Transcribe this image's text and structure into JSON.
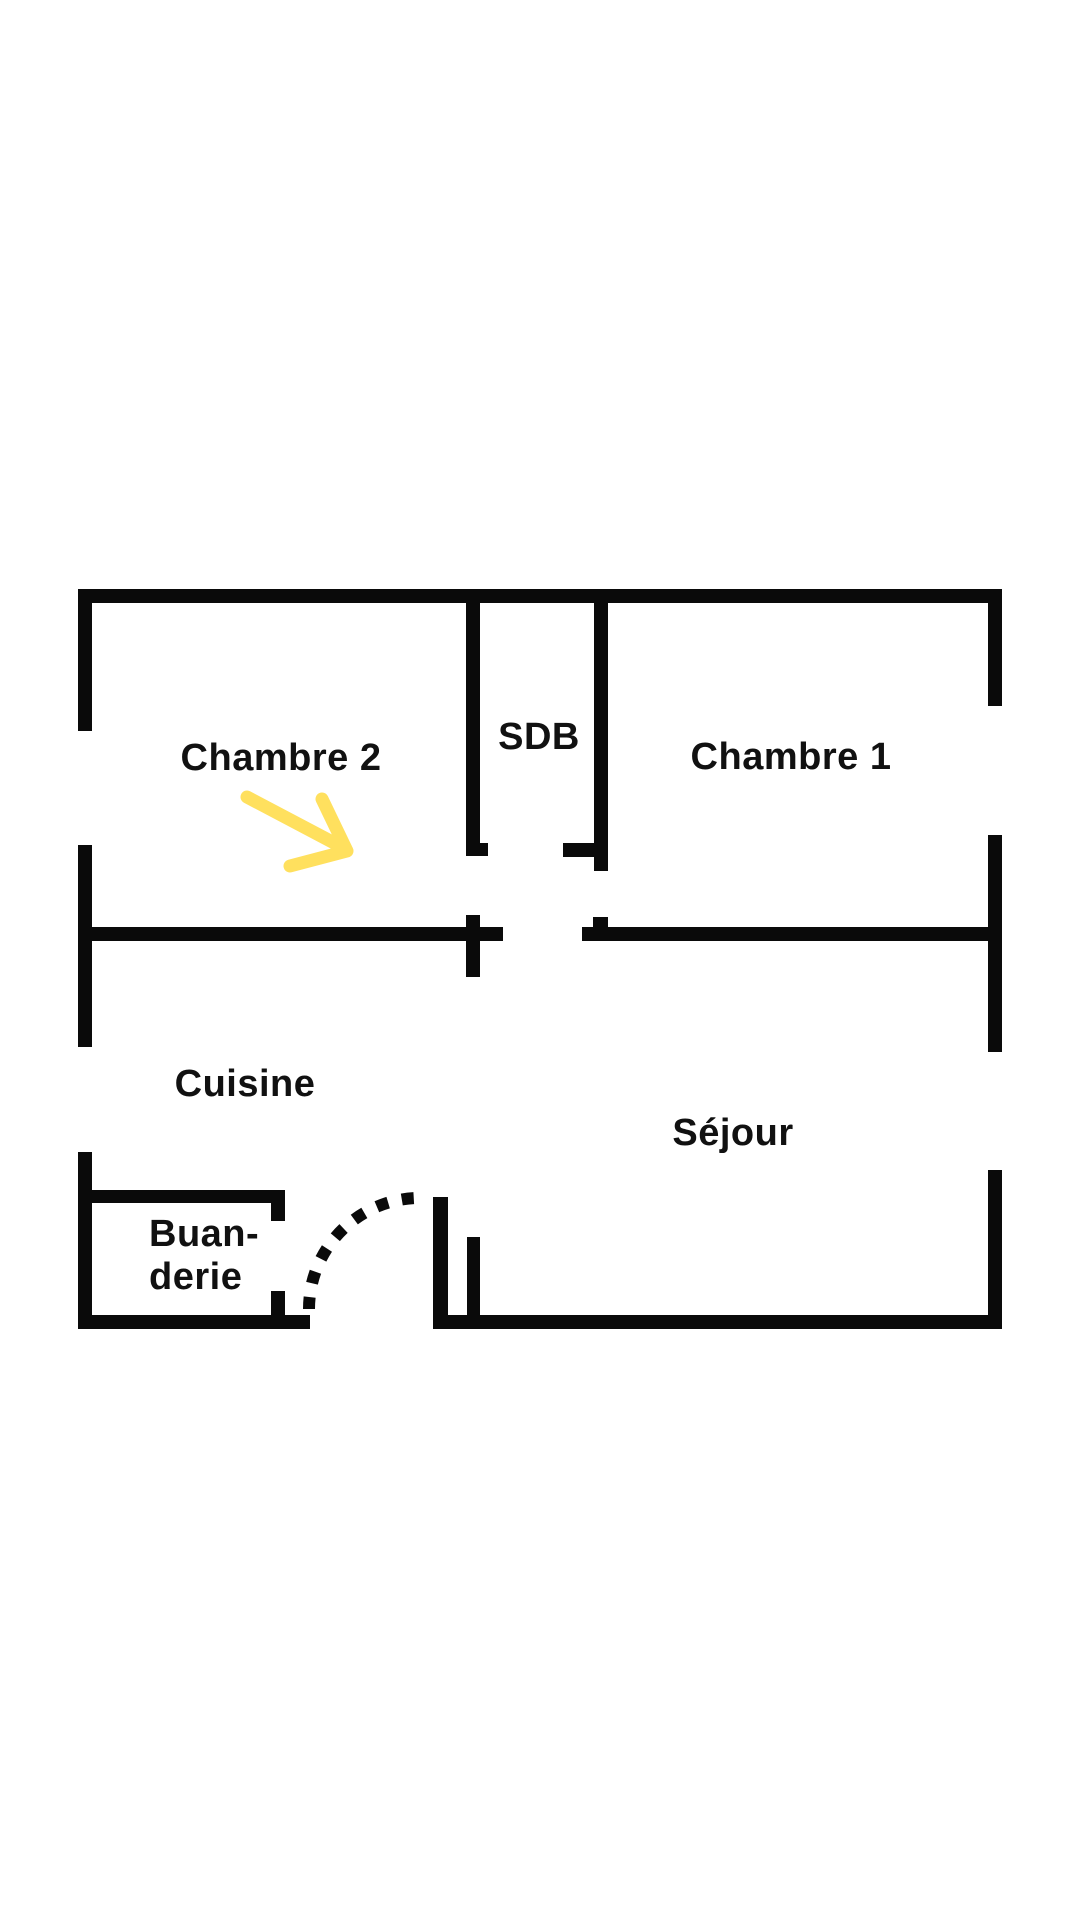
{
  "title": "Apartment floor plan",
  "background": "#ffffff",
  "plan": {
    "wall_color": "#0a0a0a",
    "text_color": "#111111",
    "labels": [
      {
        "id": "chambre-2",
        "text": "Chambre 2"
      },
      {
        "id": "sdb",
        "text": "SDB"
      },
      {
        "id": "chambre-1",
        "text": "Chambre 1"
      },
      {
        "id": "cuisine",
        "text": "Cuisine"
      },
      {
        "id": "sejour",
        "text": "Séjour"
      },
      {
        "id": "buanderie-line1",
        "text": "Buan-"
      },
      {
        "id": "buanderie-line2",
        "text": "derie"
      }
    ],
    "walls": [
      {
        "name": "outer-top-wall",
        "x": 78,
        "y": 589,
        "w": 924,
        "h": 14
      },
      {
        "name": "outer-left-wall-upper",
        "x": 78,
        "y": 589,
        "w": 14,
        "h": 142
      },
      {
        "name": "outer-left-wall-middle",
        "x": 78,
        "y": 845,
        "w": 14,
        "h": 202
      },
      {
        "name": "outer-left-wall-lower",
        "x": 78,
        "y": 1152,
        "w": 14,
        "h": 177
      },
      {
        "name": "outer-right-wall-upper",
        "x": 988,
        "y": 589,
        "w": 14,
        "h": 117
      },
      {
        "name": "outer-right-wall-middle",
        "x": 988,
        "y": 835,
        "w": 14,
        "h": 217
      },
      {
        "name": "outer-right-wall-lower",
        "x": 988,
        "y": 1170,
        "w": 14,
        "h": 159
      },
      {
        "name": "sdb-left-wall",
        "x": 466,
        "y": 603,
        "w": 14,
        "h": 253
      },
      {
        "name": "sdb-left-door-jamb",
        "x": 466,
        "y": 843,
        "w": 22,
        "h": 13
      },
      {
        "name": "sdb-right-wall",
        "x": 594,
        "y": 603,
        "w": 14,
        "h": 268
      },
      {
        "name": "sdb-right-door-jamb",
        "x": 563,
        "y": 843,
        "w": 31,
        "h": 14
      },
      {
        "name": "middle-wall-left",
        "x": 78,
        "y": 927,
        "w": 425,
        "h": 14
      },
      {
        "name": "middle-wall-cross-stub",
        "x": 466,
        "y": 915,
        "w": 14,
        "h": 62
      },
      {
        "name": "middle-wall-right",
        "x": 582,
        "y": 927,
        "w": 420,
        "h": 14
      },
      {
        "name": "middle-wall-top-stub",
        "x": 593,
        "y": 917,
        "w": 15,
        "h": 10
      },
      {
        "name": "bottom-wall-left",
        "x": 78,
        "y": 1315,
        "w": 232,
        "h": 14
      },
      {
        "name": "bottom-wall-right",
        "x": 433,
        "y": 1315,
        "w": 569,
        "h": 14
      },
      {
        "name": "buanderie-top-wall",
        "x": 78,
        "y": 1190,
        "w": 207,
        "h": 13
      },
      {
        "name": "buanderie-top-wall-jamb",
        "x": 271,
        "y": 1190,
        "w": 14,
        "h": 31
      },
      {
        "name": "buanderie-door-jamb",
        "x": 271,
        "y": 1291,
        "w": 14,
        "h": 24
      },
      {
        "name": "kitchen-door-leaf",
        "x": 433,
        "y": 1197,
        "w": 15,
        "h": 132
      },
      {
        "name": "sejour-entry-stub",
        "x": 467,
        "y": 1237,
        "w": 13,
        "h": 92
      }
    ],
    "door_arc": {
      "path": "M 309 1309 A 111 111 0 0 1 420 1198",
      "dash": "12 14",
      "width": "12"
    },
    "arrow": {
      "color": "#ffe05e",
      "shaft_path": "M 247 797 L 338 845",
      "head_path": "M 322 799 L 347 851 L 290 866",
      "width": "13"
    }
  }
}
